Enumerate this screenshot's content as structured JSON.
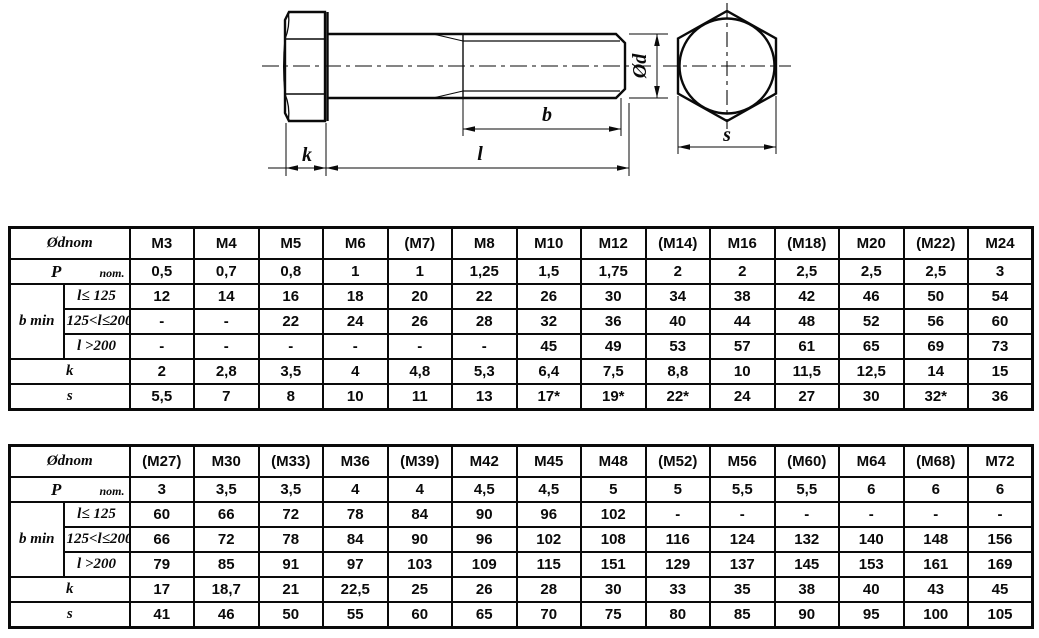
{
  "drawing": {
    "dim_labels": {
      "k": "k",
      "l": "l",
      "b": "b",
      "d": "Ød",
      "s": "s"
    }
  },
  "shared": {
    "corner_label": "Ødnom",
    "p_label": "P",
    "p_sub": "nom.",
    "b_label": "b min",
    "b_sub1": "l≤ 125",
    "b_sub2": "125<l≤200",
    "b_sub3": "l >200",
    "k_label": "k",
    "s_label": "s"
  },
  "table1": {
    "columns": [
      "M3",
      "M4",
      "M5",
      "M6",
      "(M7)",
      "M8",
      "M10",
      "M12",
      "(M14)",
      "M16",
      "(M18)",
      "M20",
      "(M22)",
      "M24"
    ],
    "p": [
      "0,5",
      "0,7",
      "0,8",
      "1",
      "1",
      "1,25",
      "1,5",
      "1,75",
      "2",
      "2",
      "2,5",
      "2,5",
      "2,5",
      "3"
    ],
    "b1": [
      "12",
      "14",
      "16",
      "18",
      "20",
      "22",
      "26",
      "30",
      "34",
      "38",
      "42",
      "46",
      "50",
      "54"
    ],
    "b2": [
      "-",
      "-",
      "22",
      "24",
      "26",
      "28",
      "32",
      "36",
      "40",
      "44",
      "48",
      "52",
      "56",
      "60"
    ],
    "b3": [
      "-",
      "-",
      "-",
      "-",
      "-",
      "-",
      "45",
      "49",
      "53",
      "57",
      "61",
      "65",
      "69",
      "73"
    ],
    "k": [
      "2",
      "2,8",
      "3,5",
      "4",
      "4,8",
      "5,3",
      "6,4",
      "7,5",
      "8,8",
      "10",
      "11,5",
      "12,5",
      "14",
      "15"
    ],
    "s": [
      "5,5",
      "7",
      "8",
      "10",
      "11",
      "13",
      "17*",
      "19*",
      "22*",
      "24",
      "27",
      "30",
      "32*",
      "36"
    ]
  },
  "table2": {
    "columns": [
      "(M27)",
      "M30",
      "(M33)",
      "M36",
      "(M39)",
      "M42",
      "M45",
      "M48",
      "(M52)",
      "M56",
      "(M60)",
      "M64",
      "(M68)",
      "M72"
    ],
    "p": [
      "3",
      "3,5",
      "3,5",
      "4",
      "4",
      "4,5",
      "4,5",
      "5",
      "5",
      "5,5",
      "5,5",
      "6",
      "6",
      "6"
    ],
    "b1": [
      "60",
      "66",
      "72",
      "78",
      "84",
      "90",
      "96",
      "102",
      "-",
      "-",
      "-",
      "-",
      "-",
      "-"
    ],
    "b2": [
      "66",
      "72",
      "78",
      "84",
      "90",
      "96",
      "102",
      "108",
      "116",
      "124",
      "132",
      "140",
      "148",
      "156"
    ],
    "b3": [
      "79",
      "85",
      "91",
      "97",
      "103",
      "109",
      "115",
      "151",
      "129",
      "137",
      "145",
      "153",
      "161",
      "169"
    ],
    "k": [
      "17",
      "18,7",
      "21",
      "22,5",
      "25",
      "26",
      "28",
      "30",
      "33",
      "35",
      "38",
      "40",
      "43",
      "45"
    ],
    "s": [
      "41",
      "46",
      "50",
      "55",
      "60",
      "65",
      "70",
      "75",
      "80",
      "85",
      "90",
      "95",
      "100",
      "105"
    ]
  }
}
